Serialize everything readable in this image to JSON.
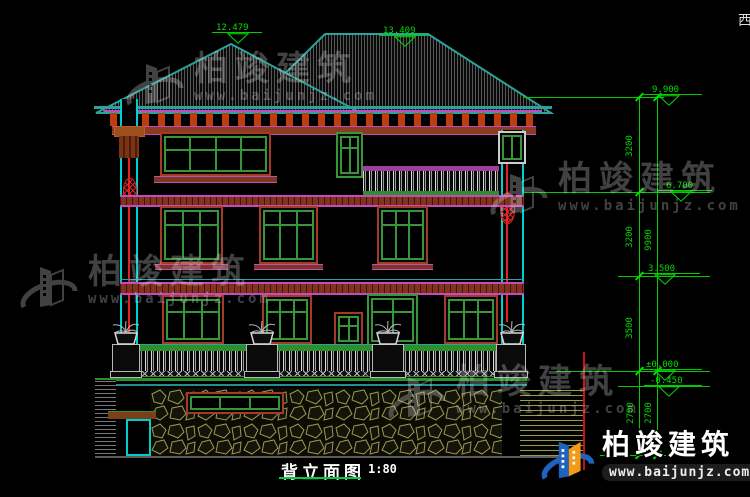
{
  "drawing": {
    "title": "背立面图",
    "scale": "1:80",
    "corner_text": "西",
    "ridge_markers": {
      "left": "12.479",
      "right": "13.409"
    },
    "levels": {
      "eave": "9.900",
      "l3": "6.700",
      "l2": "3.500",
      "ground": "±0.000",
      "terrace": "-0.450"
    },
    "dims": {
      "f3": "3200",
      "f2": "3200",
      "f1": "3500",
      "overall": "9900",
      "base_inner": "2700",
      "base_outer": "2700"
    }
  },
  "watermark": {
    "brand": "柏竣建筑",
    "url": "www.baijunjz.com"
  },
  "logo": {
    "brand": "柏竣建筑",
    "url": "www.baijunjz.com"
  },
  "colors": {
    "dim_green": "#00dd00",
    "cad_cyan": "#00cfcf",
    "roof_teal": "#2ba39b",
    "frame_green": "#37953a",
    "surround_red": "#a63a2a",
    "band_magenta": "#c34ac3",
    "accent_red": "#e42222",
    "stone_olive": "#9a9a52",
    "logo_blue": "#1f63c0",
    "logo_orange": "#f59a18"
  }
}
